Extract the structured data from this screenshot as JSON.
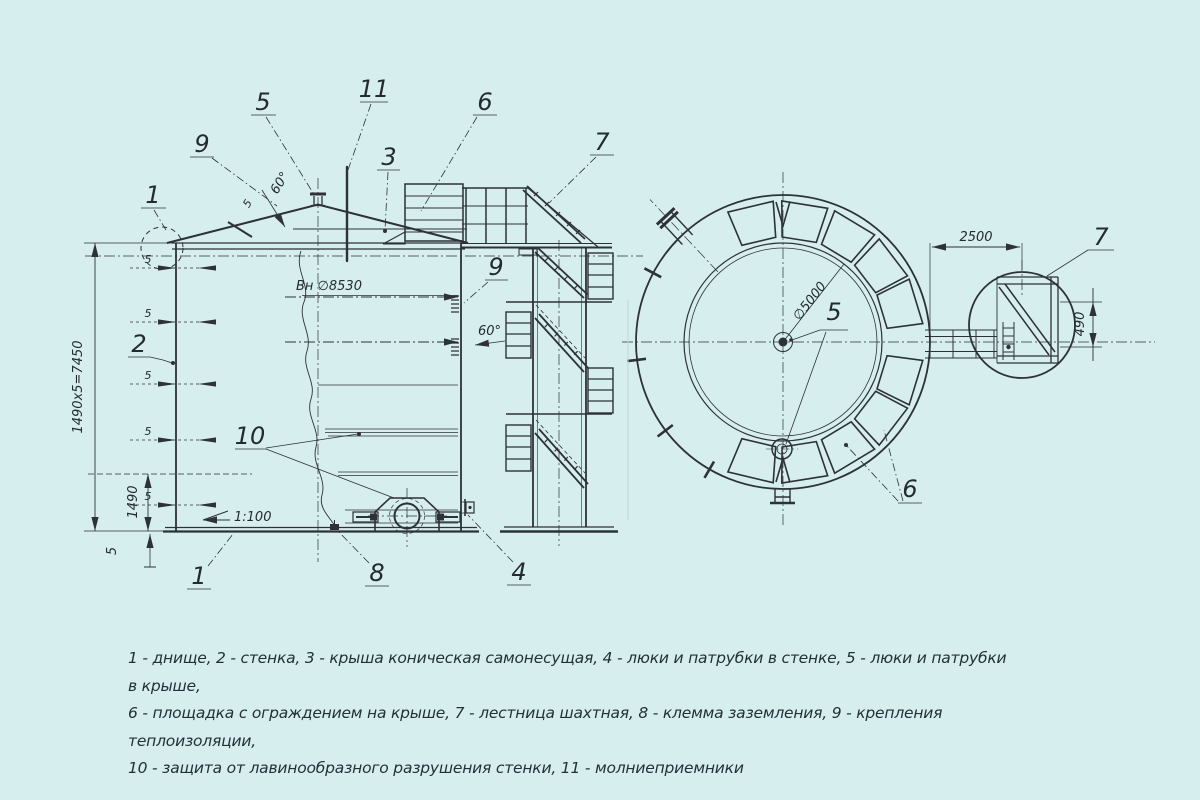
{
  "colors": {
    "background": "#d7eeee",
    "line": "#2d3138"
  },
  "legend": {
    "line1": "1 - днище, 2 - стенка, 3 - крыша коническая самонесущая, 4 - люки и патрубки в стенке, 5 - люки и патрубки в крыше,",
    "line2": "6 - площадка с ограждением на крыше, 7 - лестница шахтная, 8 - клемма заземления, 9 - крепления теплоизоляции,",
    "line3": "10 - защита от лавинообразного разрушения стенки, 11 - молниеприемники"
  },
  "callouts": {
    "c1_top": "1",
    "c9_roof": "9",
    "c5_roof": "5",
    "c11": "11",
    "c3": "3",
    "c6_roof": "6",
    "c7_ladder": "7",
    "c9_wall": "9",
    "c2": "2",
    "c10": "10",
    "c1_bottom": "1",
    "c8": "8",
    "c4": "4",
    "c5_plan": "5",
    "c6_plan": "6",
    "c7_plan": "7"
  },
  "dimensions": {
    "wall_height": "1490х5=7450",
    "course_height": "1490",
    "bottom_thickness": "5",
    "weld_size": "5",
    "inner_diameter": "Вн ∅8530",
    "roof_angle": "60°",
    "roof_weld": "5",
    "stair_angle": "60°",
    "bottom_slope": "1:100",
    "plan_diameter": "∅5000",
    "ladder_offset": "2500",
    "walkway_width": "490"
  }
}
